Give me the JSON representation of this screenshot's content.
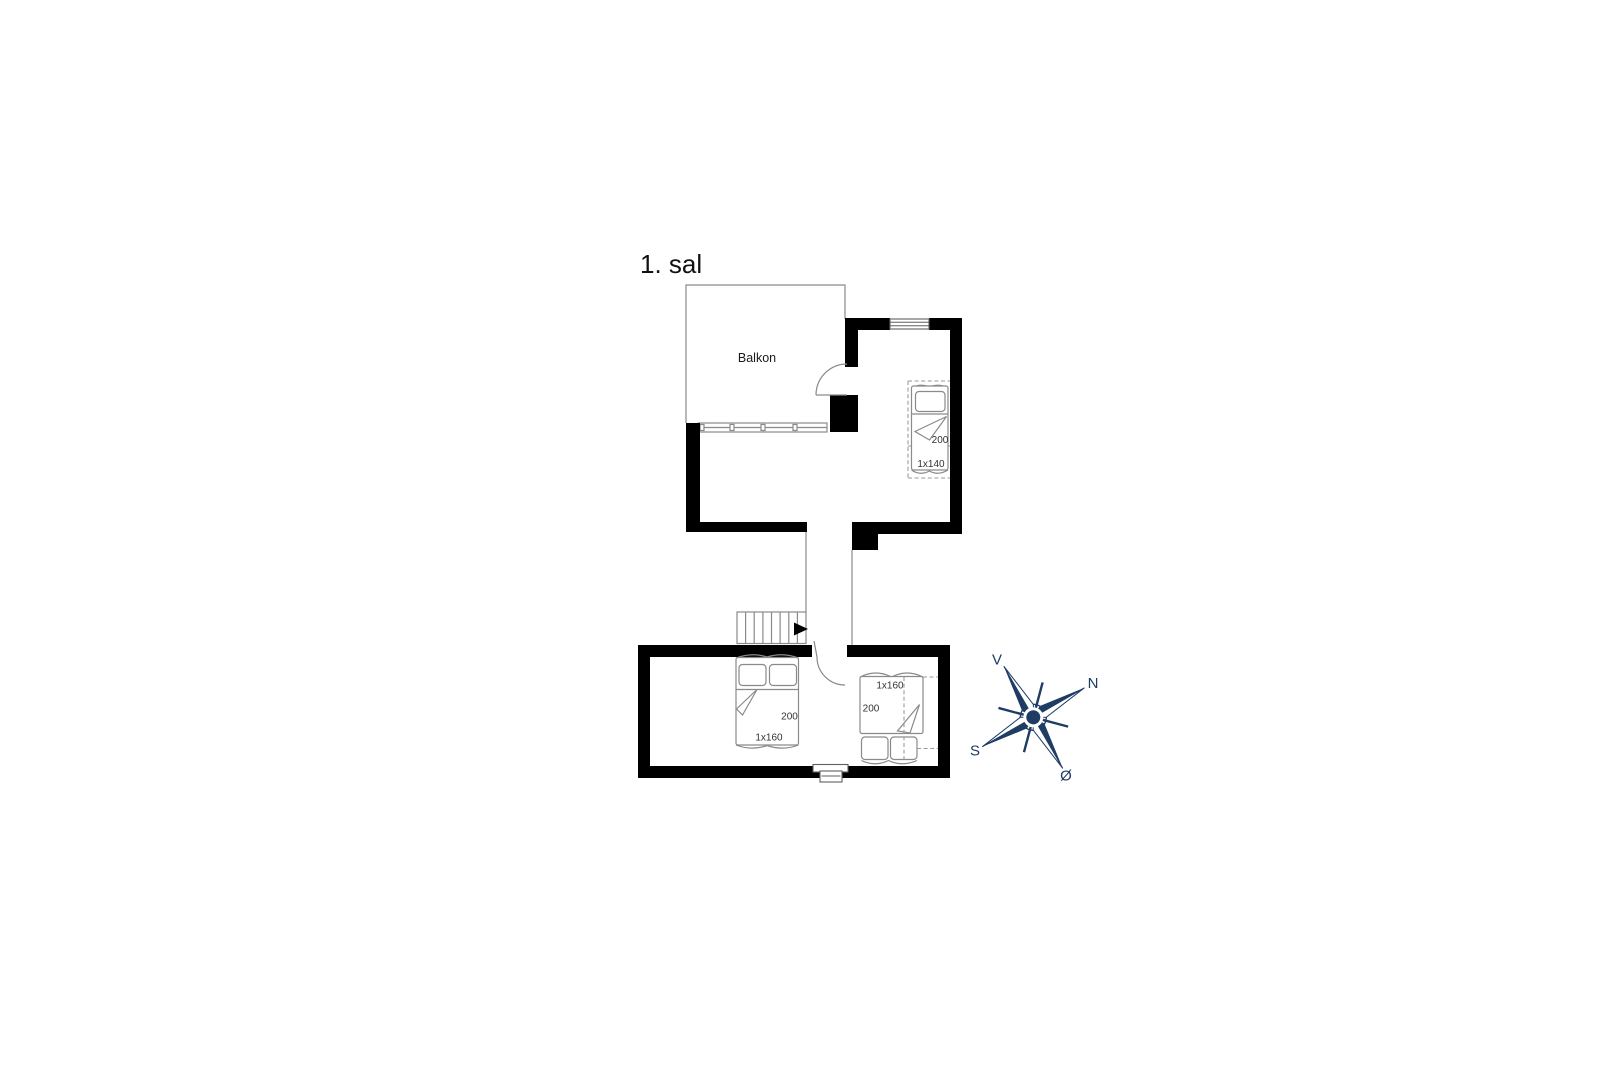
{
  "title": "1. sal",
  "balcony": {
    "label": "Balkon"
  },
  "beds": {
    "upper_single": {
      "length": "200",
      "size": "1x140"
    },
    "master_double": {
      "length": "200",
      "size": "1x160"
    },
    "second_double": {
      "size": "1x160",
      "length": "200"
    }
  },
  "compass": {
    "west": "V",
    "north": "N",
    "south": "S",
    "east": "Ø",
    "color": "#1f3c64"
  },
  "colors": {
    "wall": "#000000",
    "outline": "#8a8a8a",
    "label": "#333333",
    "title": "#111111"
  }
}
